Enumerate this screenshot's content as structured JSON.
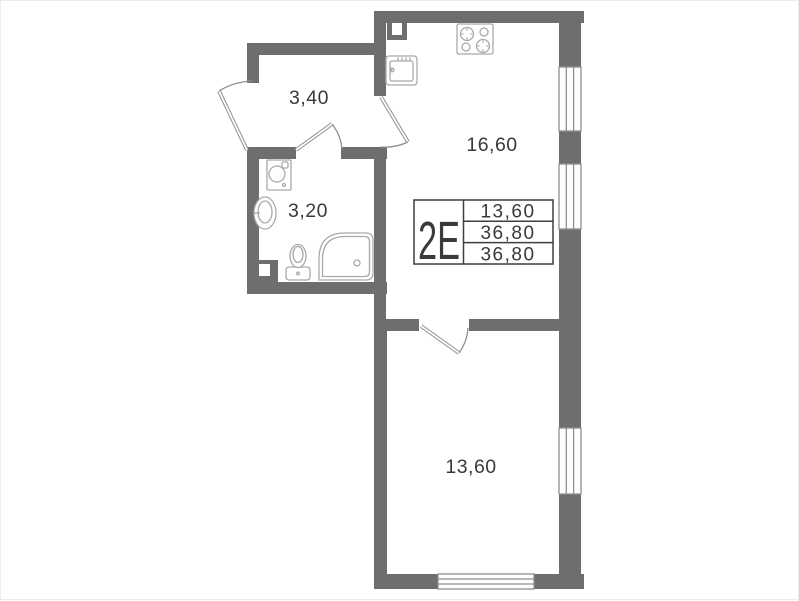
{
  "colors": {
    "wall": "#6e6e6e",
    "outline": "#8f8f8f",
    "fixture": "#a9a9a9",
    "text": "#3a3a3a",
    "table_border": "#3f3f3f"
  },
  "unit": {
    "label": "2Е",
    "areas": {
      "living": "13,60",
      "total": "36,80",
      "overall": "36,80"
    }
  },
  "rooms": [
    {
      "id": "hall",
      "area": "3,40"
    },
    {
      "id": "bathroom",
      "area": "3,20"
    },
    {
      "id": "kitchen-living",
      "area": "16,60"
    },
    {
      "id": "room",
      "area": "13,60"
    }
  ],
  "fixtures": [
    "stove",
    "kitchen-sink",
    "washing-machine",
    "bathroom-sink",
    "toilet",
    "corner-bath"
  ]
}
